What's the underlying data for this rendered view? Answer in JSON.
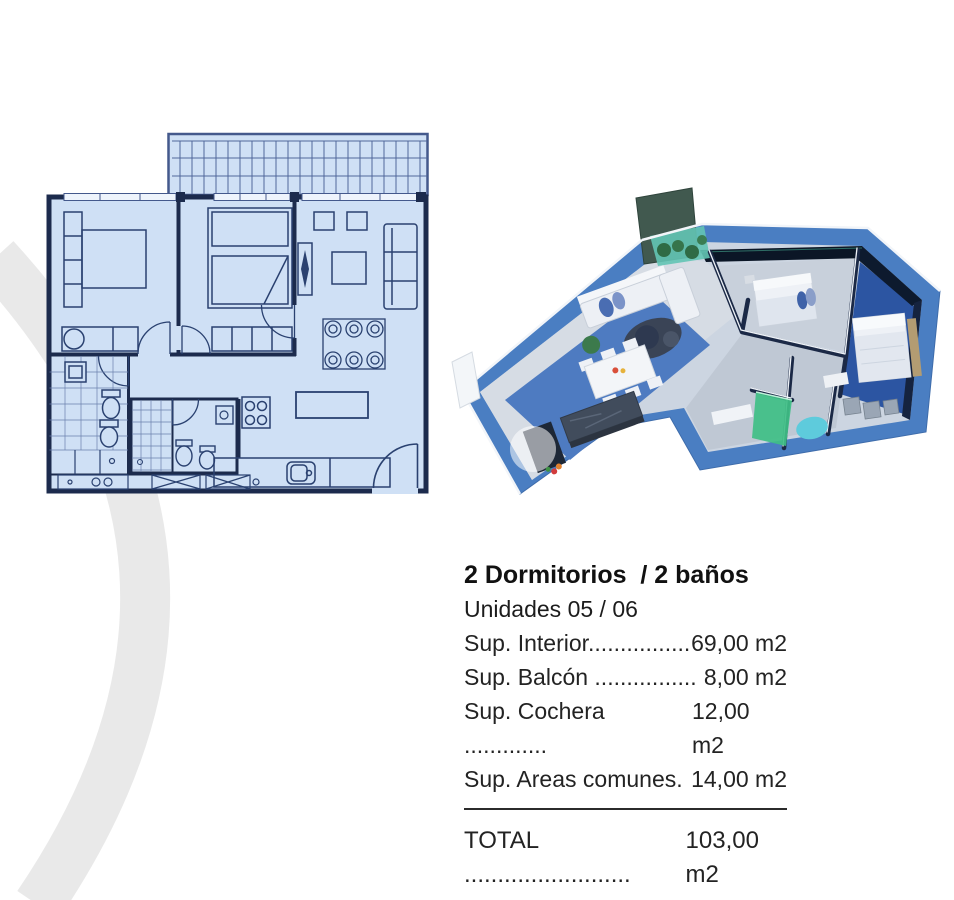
{
  "content": {
    "title": "2 Dormitorios  / 2 baños",
    "subtitle": "Unidades 05 / 06",
    "specs": [
      {
        "label": "Sup. Interior................",
        "value": "69,00 m2"
      },
      {
        "label": "Sup. Balcón ................",
        "value": "8,00 m2"
      },
      {
        "label": "Sup. Cochera .............",
        "value": "12,00 m2"
      },
      {
        "label": "Sup. Areas comunes.",
        "value": "14,00 m2"
      }
    ],
    "total_label": "TOTAL .........................",
    "total_value": "103,00 m2"
  },
  "figures": {
    "floorplan_2d": "2d-blueprint-floorplan",
    "floorplan_3d": "3d-isometric-floorplan-render",
    "watermark": "gray-ring-watermark"
  },
  "palette": {
    "plan_fill": "#cfe0f5",
    "plan_line": "#1c2b4d",
    "slab_blue": "#4a7ec2",
    "carpet_blue": "#4e7bc1",
    "glass_dark": "#0b1626",
    "shower_green": "#3fbf85",
    "tub_aqua": "#5ecbdc",
    "balcony_teal": "#63c4b4",
    "text": "#232323",
    "watermark_gray": "#e9e9e9"
  }
}
